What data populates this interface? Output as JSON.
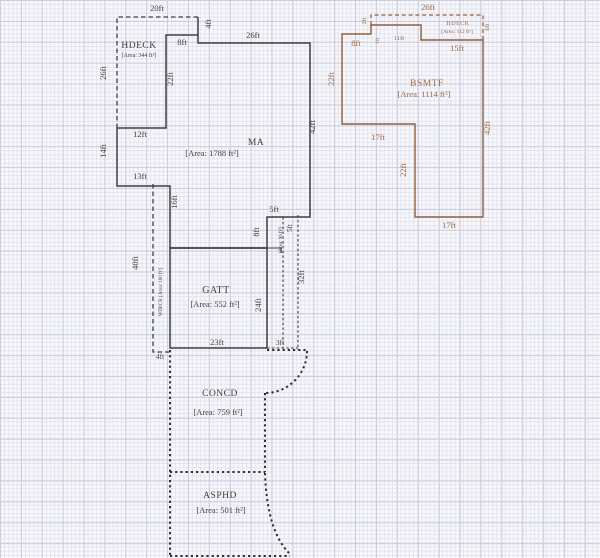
{
  "title": "floor-plan-sketch",
  "colors": {
    "paper": "#f8f8fb",
    "grid_minor": "#e2e3ef",
    "grid_major": "#cbcddf",
    "outline_ink": "#3f3f41",
    "outline_brown": "#8e5f3e",
    "dim_text": "#4a423c",
    "dim_text_brown": "#9c6a47"
  },
  "rooms": {
    "hdeck_left": {
      "name": "HDECK",
      "area": "[Area: 344 ft²]"
    },
    "ma": {
      "name": "MA",
      "area": "[Area: 1788 ft²]"
    },
    "gatt": {
      "name": "GATT",
      "area": "[Area: 552 ft²]"
    },
    "wdeck_strip": {
      "label": "WDECK [Area: 160 ft²]"
    },
    "porch_strip": {
      "label": "[Area: 96 ft²]"
    },
    "concd": {
      "name": "CONCD",
      "area": "[Area: 759 ft²]"
    },
    "asphd": {
      "name": "ASPHD",
      "area": "[Area: 501 ft²]"
    },
    "bsmtf": {
      "name": "BSMTF",
      "area": "[Area: 1114 ft²]"
    },
    "hdeck_right": {
      "name": "HDECK",
      "area": "[Area: 112 ft²]"
    }
  },
  "labels": [
    {
      "t": "20ft",
      "x": 157,
      "y": 11,
      "c": "dim"
    },
    {
      "t": "4ft",
      "x": 211,
      "y": 24,
      "r": -90,
      "c": "dim"
    },
    {
      "t": "8ft",
      "x": 182,
      "y": 45,
      "c": "dim"
    },
    {
      "t": "26ft",
      "x": 253,
      "y": 38,
      "c": "dim"
    },
    {
      "t": "26ft",
      "x": 106,
      "y": 73,
      "r": -90,
      "c": "dim"
    },
    {
      "t": "22ft",
      "x": 173,
      "y": 79,
      "r": -90,
      "c": "dim"
    },
    {
      "t": "12ft",
      "x": 140,
      "y": 137,
      "c": "dim"
    },
    {
      "t": "14ft",
      "x": 106,
      "y": 151,
      "r": -90,
      "c": "dim"
    },
    {
      "t": "13ft",
      "x": 140,
      "y": 179,
      "c": "dim"
    },
    {
      "t": "42ft",
      "x": 315,
      "y": 127,
      "r": -90,
      "c": "dim"
    },
    {
      "t": "16ft",
      "x": 177,
      "y": 202,
      "r": -90,
      "c": "dim"
    },
    {
      "t": "5ft",
      "x": 274,
      "y": 212,
      "c": "dim"
    },
    {
      "t": "8ft",
      "x": 259,
      "y": 232,
      "r": -90,
      "c": "dim"
    },
    {
      "t": "5ft",
      "x": 292,
      "y": 228,
      "r": -90,
      "fs": 7,
      "c": "dim"
    },
    {
      "t": "32ft",
      "x": 304,
      "y": 277,
      "r": -90,
      "c": "dim"
    },
    {
      "t": "24ft",
      "x": 261,
      "y": 305,
      "r": -90,
      "c": "dim"
    },
    {
      "t": "23ft",
      "x": 217,
      "y": 345,
      "c": "dim"
    },
    {
      "t": "3ft",
      "x": 280,
      "y": 345,
      "fs": 7.5,
      "c": "dim"
    },
    {
      "t": "40ft",
      "x": 138,
      "y": 263,
      "r": -90,
      "c": "dim"
    },
    {
      "t": "4ft",
      "x": 160,
      "y": 359,
      "fs": 7.5,
      "c": "dim"
    },
    {
      "t": "26ft",
      "x": 428,
      "y": 10,
      "c": "bdim"
    },
    {
      "t": "2ft",
      "x": 366,
      "y": 21,
      "r": -90,
      "fs": 6,
      "c": "bdim"
    },
    {
      "t": "8ft",
      "x": 356,
      "y": 46,
      "c": "bdim"
    },
    {
      "t": "1ft",
      "x": 379,
      "y": 41,
      "r": -90,
      "fs": 5.5,
      "c": "bdim"
    },
    {
      "t": "11ft",
      "x": 399,
      "y": 40,
      "fs": 6.5,
      "c": "bdim"
    },
    {
      "t": "6ft",
      "x": 489,
      "y": 27,
      "r": -90,
      "fs": 6.5,
      "c": "bdim"
    },
    {
      "t": "15ft",
      "x": 457,
      "y": 51,
      "c": "bdim"
    },
    {
      "t": "22ft",
      "x": 334,
      "y": 79,
      "r": -90,
      "c": "bdim"
    },
    {
      "t": "42ft",
      "x": 490,
      "y": 128,
      "r": -90,
      "c": "bdim"
    },
    {
      "t": "17ft",
      "x": 378,
      "y": 140,
      "c": "bdim"
    },
    {
      "t": "22ft",
      "x": 406,
      "y": 170,
      "r": -90,
      "c": "bdim"
    },
    {
      "t": "17ft",
      "x": 449,
      "y": 228,
      "c": "bdim"
    },
    {
      "t": "HDECK",
      "x": 139,
      "y": 48,
      "fs": 9.5,
      "c": "room",
      "n": "hdeck-left-name"
    },
    {
      "t": "[Area: 344 ft²]",
      "x": 139,
      "y": 57,
      "fs": 6,
      "c": "area",
      "n": "hdeck-left-area"
    },
    {
      "t": "MA",
      "x": 256,
      "y": 145,
      "fs": 9.5,
      "c": "room",
      "n": "ma-name"
    },
    {
      "t": "[Area: 1788 ft²]",
      "x": 212,
      "y": 156,
      "fs": 8.5,
      "c": "area",
      "n": "ma-area"
    },
    {
      "t": "GATT",
      "x": 216,
      "y": 293,
      "fs": 10,
      "c": "room",
      "n": "gatt-name"
    },
    {
      "t": "[Area: 552 ft²]",
      "x": 215,
      "y": 307,
      "fs": 8.5,
      "c": "area",
      "n": "gatt-area"
    },
    {
      "t": "CONCD",
      "x": 220,
      "y": 396,
      "fs": 9.5,
      "c": "room",
      "n": "concd-name"
    },
    {
      "t": "[Area: 759 ft²]",
      "x": 218,
      "y": 415,
      "fs": 8.5,
      "c": "area",
      "n": "concd-area"
    },
    {
      "t": "ASPHD",
      "x": 220,
      "y": 498,
      "fs": 9.5,
      "c": "room",
      "n": "asphd-name"
    },
    {
      "t": "[Area: 501 ft²]",
      "x": 221,
      "y": 513,
      "fs": 8.5,
      "c": "area",
      "n": "asphd-area"
    },
    {
      "t": "BSMTF",
      "x": 427,
      "y": 86,
      "fs": 9.5,
      "c": "broom",
      "n": "bsmtf-name"
    },
    {
      "t": "[Area: 1114 ft²]",
      "x": 424,
      "y": 97,
      "fs": 8.5,
      "c": "barea",
      "n": "bsmtf-area"
    },
    {
      "t": "HDECK",
      "x": 458,
      "y": 25,
      "fs": 6,
      "c": "broom",
      "n": "hdeck-right-name"
    },
    {
      "t": "[Area: 112 ft²]",
      "x": 457,
      "y": 33,
      "fs": 5.5,
      "c": "barea",
      "n": "hdeck-right-area"
    },
    {
      "t": "WDECK [Area: 160 ft²]",
      "x": 162,
      "y": 292,
      "r": -90,
      "fs": 5,
      "c": "area",
      "n": "wdeck-strip-label"
    },
    {
      "t": "[Area: 96 ft²]",
      "x": 282,
      "y": 240,
      "r": -90,
      "fs": 5,
      "c": "area",
      "n": "porch-strip-label"
    }
  ]
}
